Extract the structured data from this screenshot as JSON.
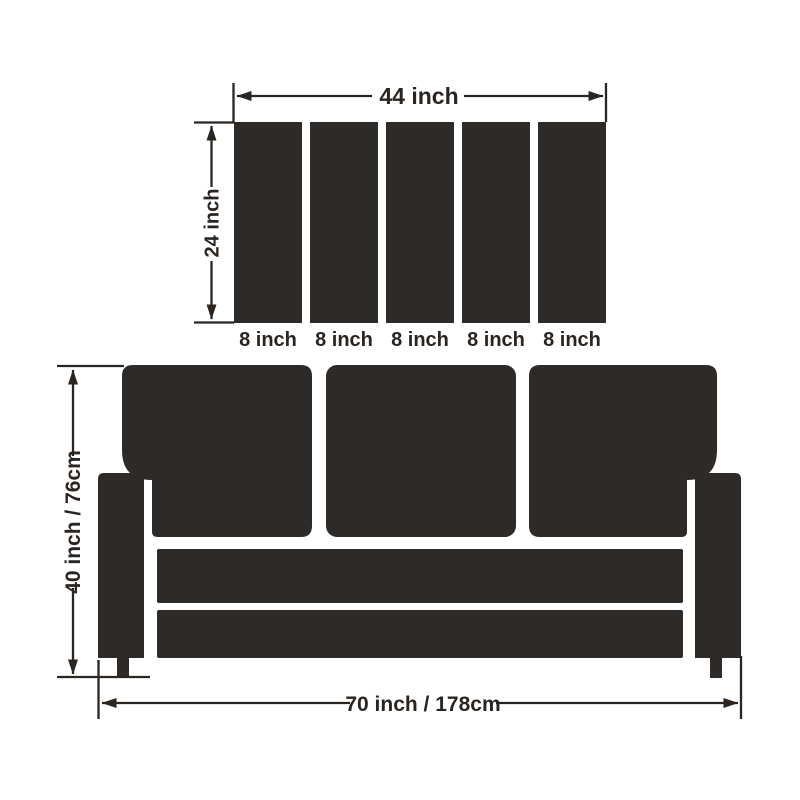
{
  "page": {
    "background_color": "#ffffff"
  },
  "diagram": {
    "kind": "sofa-slipcover-dimension-diagram",
    "ink_color": "#2b2521",
    "shape_fill_color": "#2e2a28",
    "back_cushion_panel": {
      "width_label": "44 inch",
      "height_label": "24 inch",
      "panel_count": 5,
      "panel_labels": [
        "8 inch",
        "8 inch",
        "8 inch",
        "8 inch",
        "8 inch"
      ]
    },
    "sofa": {
      "cushion_count": 3,
      "height_label": "40 inch / 76cm",
      "width_label": "70 inch / 178cm"
    }
  }
}
